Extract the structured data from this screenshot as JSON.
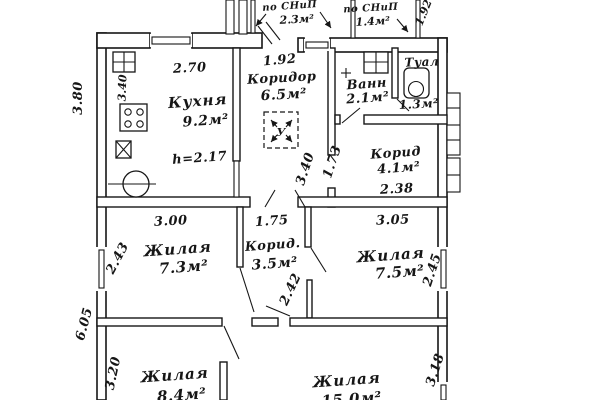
{
  "drawing": {
    "type": "apartment-floor-plan",
    "colors": {
      "ink": "#161616",
      "paper": "#ffffff"
    }
  },
  "rooms": {
    "kitchen": {
      "name": "Кухня",
      "area": "9.2м²",
      "height_note": "h=2.17"
    },
    "corridor": {
      "name": "Коридор",
      "area": "6.5м²"
    },
    "hatch": {
      "label": "У"
    },
    "bath": {
      "name": "Ванн",
      "area": "2.1м²"
    },
    "toilet": {
      "name": "Туал",
      "area": "1.3м²"
    },
    "corridor_right": {
      "name": "Корид",
      "area": "4.1м²"
    },
    "living1": {
      "name": "Жилая",
      "area": "7.3м²"
    },
    "corridor_small": {
      "name": "Корид.",
      "area": "3.5м²"
    },
    "living2": {
      "name": "Жилая",
      "area": "7.5м²"
    },
    "living3": {
      "name": "Жилая",
      "area": "8.4м²"
    },
    "living4": {
      "name": "Жилая",
      "area": "15.0м²"
    },
    "porch1": {
      "name": "по СНиП",
      "area": "2.3м²"
    },
    "porch2": {
      "name": "по СНиП",
      "area": "1.4м²"
    }
  },
  "dims": {
    "left_upper": "3.80",
    "left_lower": "6.05",
    "kitchen_width": "2.70",
    "kitchen_depth": "3.40",
    "corridor_width": "1.92",
    "corridor_depth_diag": "3.40",
    "corridor_right_diag": "1.73",
    "corridor_right_width": "2.38",
    "porch_diag": "1.92",
    "living1_width": "3.00",
    "living1_depth": "2.43",
    "corridor_small_width": "1.75",
    "corridor_small_depth": "2.42",
    "living2_width": "3.05",
    "living2_depth": "2.45",
    "living3_depth": "3.20",
    "living4_depth": "3.18"
  }
}
